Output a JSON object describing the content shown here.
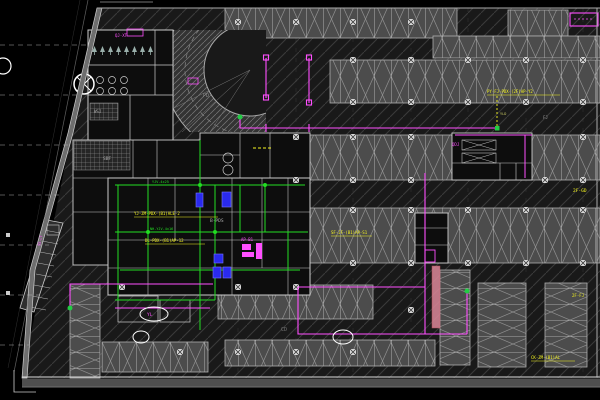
{
  "drawing": {
    "type": "cad-floor-plan",
    "description": "Basement parking garage electrical plan, dark CAD viewport",
    "background": "#000000"
  },
  "colors": {
    "background": "#000000",
    "aisle_fill": "#191919",
    "aisle_hatch": "#3a3a3a",
    "stall_fill": "#4c4c4c",
    "stall_hatch": "#8f8f8f",
    "wall_gray": "#cccccc",
    "wiring_green": "#22dd22",
    "cable_magenta": "#ff4fff",
    "annotation_yellow": "#f5f520",
    "equipment_blue": "#2a2aee",
    "highlight_pink": "#dd8899"
  },
  "labels": [
    {
      "text": "PY-FJ-PDX-(2F)AP-Y2",
      "color": "#f5f520"
    },
    {
      "text": "YJ-ZM-PDX-(B1)ALE-2",
      "color": "#f5f520"
    },
    {
      "text": "DL-PDX-(B1)AP-12",
      "color": "#f5f520"
    },
    {
      "text": "SF-JF-(B1)AP-S1",
      "color": "#f5f520"
    },
    {
      "text": "2F-GD",
      "color": "#f5f520"
    },
    {
      "text": "CK-ZM-(B1)AL",
      "color": "#f5f520"
    },
    {
      "text": "2F-FJ",
      "color": "#f5f520"
    },
    {
      "text": "QDJ",
      "color": "#ff4fff"
    },
    {
      "text": "AP-B1",
      "color": "#ff4fff"
    },
    {
      "text": "SS-LT",
      "color": "#ff4fff"
    },
    {
      "text": "QJ-XT",
      "color": "#ff4fff"
    },
    {
      "text": "YL",
      "color": "#ff4fff"
    },
    {
      "text": "FJ",
      "color": "#9a9a9a"
    },
    {
      "text": "PD",
      "color": "#8a8a8a"
    },
    {
      "text": "CD",
      "color": "#777777"
    },
    {
      "text": "YJV-4x25",
      "color": "#22dd22"
    },
    {
      "text": "NH-YJV-4x16",
      "color": "#22dd22"
    },
    {
      "text": "B-PDS",
      "color": "#aaaaaa"
    },
    {
      "text": "SBF",
      "color": "#aaaaaa"
    },
    {
      "text": "WSJ",
      "color": "#aaaaaa"
    },
    {
      "text": "YLD",
      "color": "#cccc66"
    }
  ]
}
